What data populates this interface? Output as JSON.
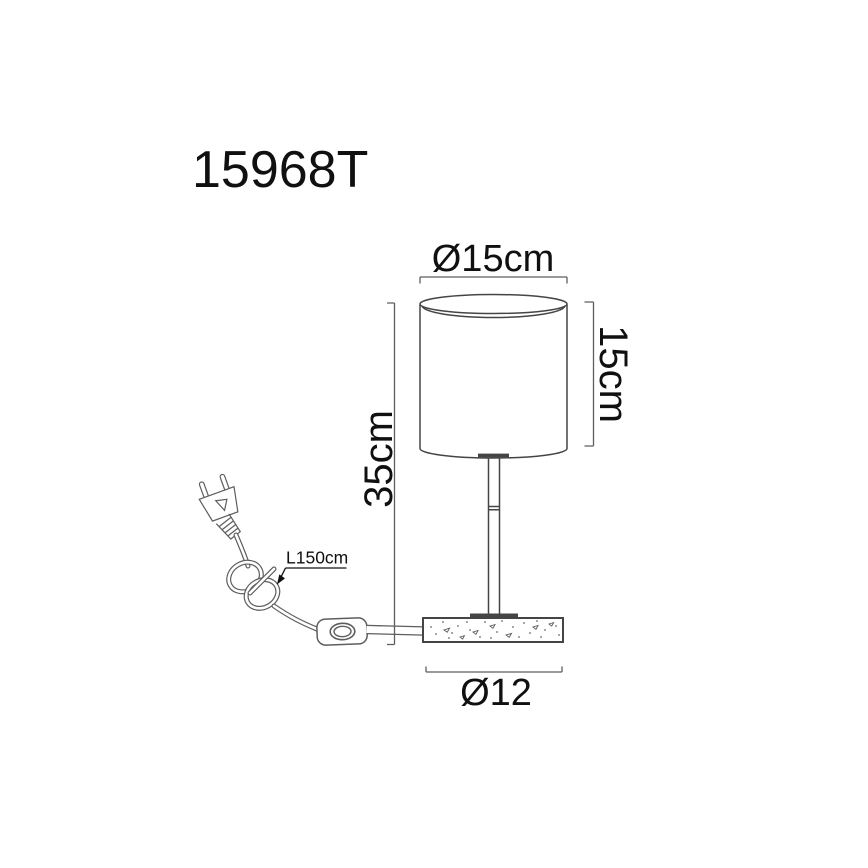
{
  "colors": {
    "background": "#ffffff",
    "line": "#454545",
    "thin_line": "#5e5e5e",
    "text": "#101010"
  },
  "title": {
    "model_code": "15968T"
  },
  "dimensions": {
    "shade_diameter": "Ø15cm",
    "shade_height": "15cm",
    "total_height": "35cm",
    "base_diameter": "Ø12",
    "cable_length": "L150cm"
  },
  "parts": {
    "shade": "cylindrical-lampshade",
    "stem": "lamp-stem",
    "base": "speckled-base",
    "plug": "eu-two-pin-plug",
    "cable": "coiled-power-cable",
    "switch": "inline-switch"
  }
}
